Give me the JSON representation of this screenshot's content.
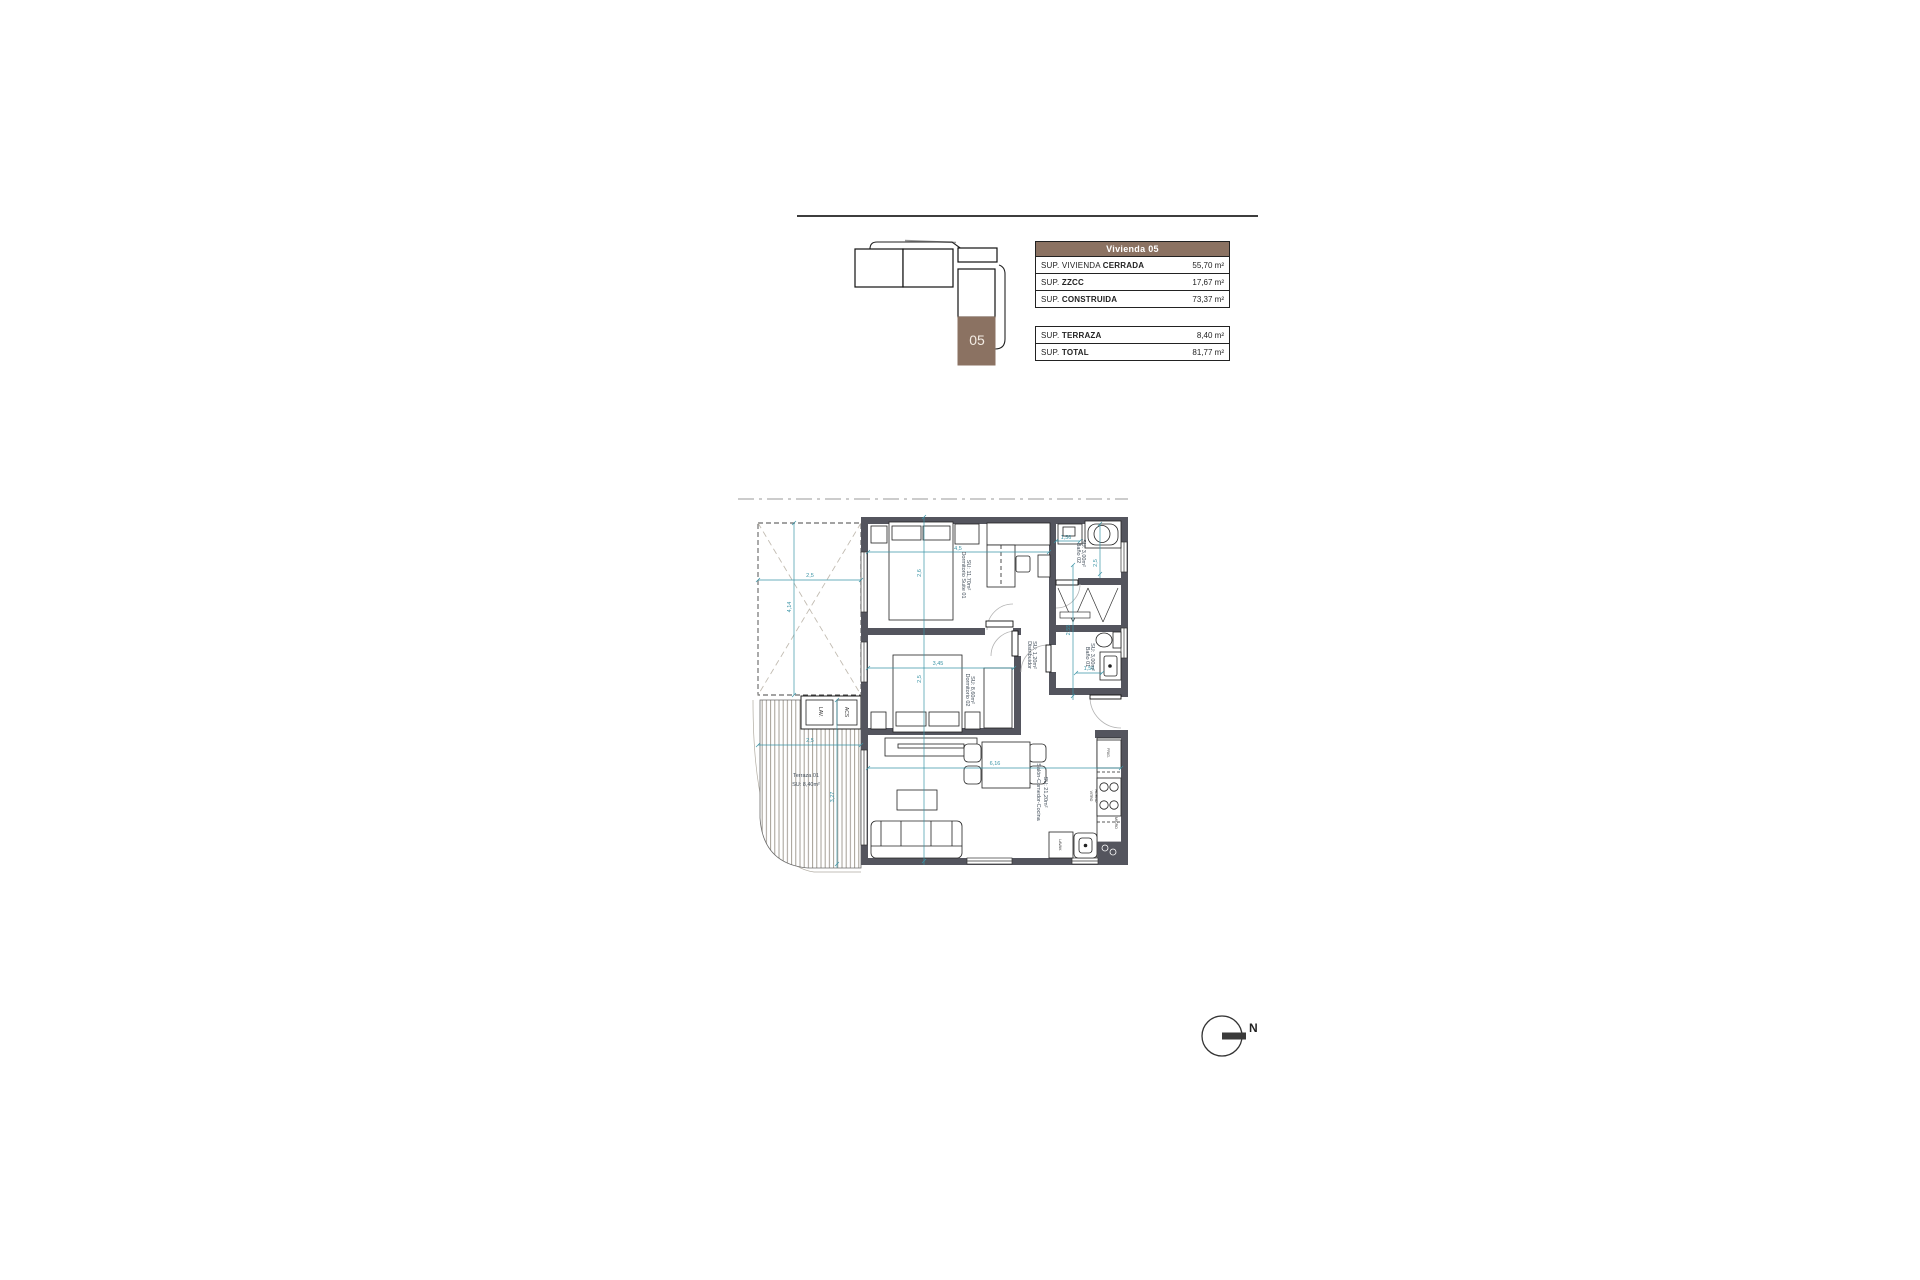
{
  "colors": {
    "brown": "#8b7262",
    "wall": "#54555e",
    "dim": "#3a94a6"
  },
  "key_plan": {
    "unit": "05"
  },
  "area_table": {
    "header": "Vivienda 05",
    "rows": [
      {
        "prefix": "SUP. VIVIENDA ",
        "bold": "CERRADA",
        "value": "55,70 m²"
      },
      {
        "prefix": "SUP. ",
        "bold": "ZZCC",
        "value": "17,67 m²"
      },
      {
        "prefix": "SUP. ",
        "bold": "CONSTRUIDA",
        "value": "73,37 m²"
      }
    ]
  },
  "totals_table": {
    "rows": [
      {
        "prefix": "SUP. ",
        "bold": "TERRAZA",
        "value": "8,40 m²"
      },
      {
        "prefix": "SUP. ",
        "bold": "TOTAL",
        "value": "81,77 m²"
      }
    ]
  },
  "plan": {
    "rooms": {
      "suite": {
        "name": "Dormitorio Suite 01",
        "area": "SU: 11,70m²"
      },
      "dorm02": {
        "name": "Dormitorio 02",
        "area": "SU: 8,60m²"
      },
      "distribuidor": {
        "name": "Distribuidor",
        "area": "SU: 1,20m²"
      },
      "bano02": {
        "name": "Baño 02",
        "area": "SU: 3,00m²"
      },
      "bano01": {
        "name": "Baño 01",
        "area": "SU: 3,00m²"
      },
      "salon": {
        "name": "Salón-Comedor-Cocina",
        "area": "SU: 21,20m²"
      },
      "terraza": {
        "name": "Terraza 01",
        "area": "SU: 8,40m²"
      }
    },
    "dims": {
      "patio_w": "2,5",
      "patio_h": "4,14",
      "suite_w": "4,5",
      "suite_h": "2,6",
      "bano02_w": "1,56",
      "bano02_h": "2,5",
      "dorm02_w": "3,45",
      "dorm02_h": "2,5",
      "distrib_h": "2,55",
      "bano01_w": "1,56",
      "salon_w": "6,16",
      "terraza_w": "2,5",
      "terraza_h": "3,27"
    },
    "labels": {
      "lav": "LAV.",
      "acs": "ACS",
      "frig": "FRIG.",
      "vitro": "VITRO",
      "horno": "HORNO",
      "micro": "MICRO",
      "lavav": "LAVAV."
    }
  },
  "north": {
    "label": "N"
  }
}
